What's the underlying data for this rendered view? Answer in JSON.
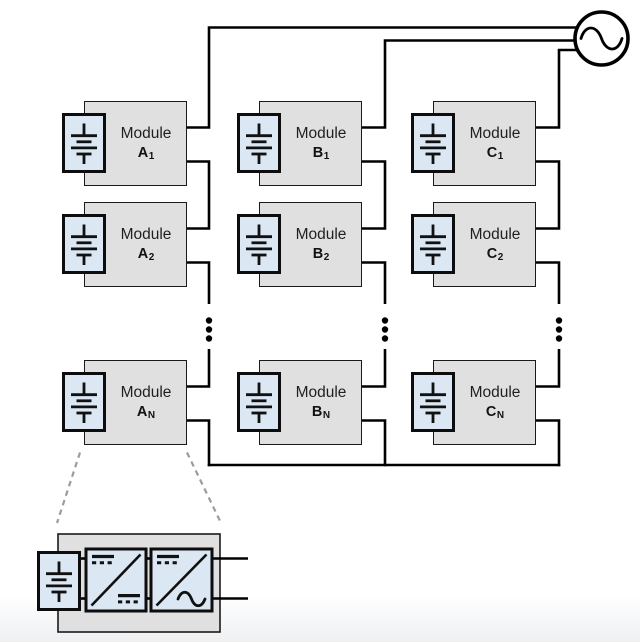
{
  "modules": [
    {
      "id": "A1",
      "line1": "Module",
      "group": "A",
      "index": "1"
    },
    {
      "id": "A2",
      "line1": "Module",
      "group": "A",
      "index": "2"
    },
    {
      "id": "AN",
      "line1": "Module",
      "group": "A",
      "index": "N"
    },
    {
      "id": "B1",
      "line1": "Module",
      "group": "B",
      "index": "1"
    },
    {
      "id": "B2",
      "line1": "Module",
      "group": "B",
      "index": "2"
    },
    {
      "id": "BN",
      "line1": "Module",
      "group": "B",
      "index": "N"
    },
    {
      "id": "C1",
      "line1": "Module",
      "group": "C",
      "index": "1"
    },
    {
      "id": "C2",
      "line1": "Module",
      "group": "C",
      "index": "2"
    },
    {
      "id": "CN",
      "line1": "Module",
      "group": "C",
      "index": "N"
    }
  ],
  "icons": {
    "ac_source": "sine-wave-in-circle",
    "battery": "multi-cell-battery-symbol",
    "dc_dc_converter": "box-diagonal-dc-over-dc",
    "dc_ac_inverter": "box-diagonal-dc-over-sine",
    "column_continuation": "vertical-ellipsis"
  },
  "colors": {
    "background": "#ffffff",
    "module_fill": "#e0e0e0",
    "module_border": "#1a1a1a",
    "component_fill": "#dbe8f4",
    "component_border": "#0d0d0d",
    "wire": "#000000",
    "leader_dash": "#9c9c9c"
  }
}
